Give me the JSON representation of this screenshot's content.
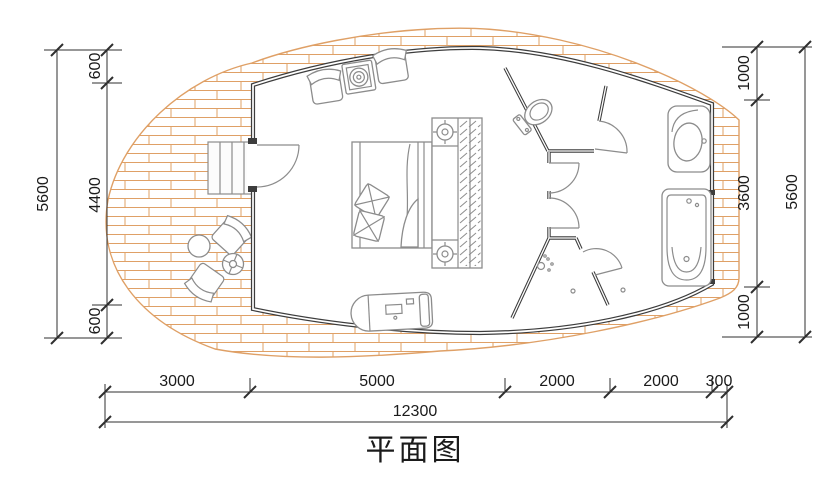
{
  "title": "平面图",
  "dims": {
    "left": {
      "segments": [
        "600",
        "4400",
        "600"
      ],
      "total": "5600"
    },
    "right": {
      "segments": [
        "1000",
        "3600",
        "1000"
      ],
      "total": "5600"
    },
    "bottom": {
      "segments": [
        "3000",
        "5000",
        "2000",
        "2000",
        "300"
      ],
      "total": "12300"
    }
  },
  "colors": {
    "wall": "#3d3d3d",
    "furniture": "#8c8c8c",
    "deck_brick": "#dfa066",
    "dimension": "#2f2f2f",
    "text": "#1b1b1b",
    "background": "#ffffff"
  },
  "symbols": [
    "stairs",
    "entry-door",
    "armchair",
    "side-table",
    "double-bed",
    "pillow",
    "wardrobe",
    "bedside-lamp",
    "toilet",
    "washbasin",
    "bathtub",
    "shower-head",
    "floor-drain",
    "chaise-bench",
    "outdoor-chair",
    "outdoor-round-table",
    "parasol-table"
  ]
}
